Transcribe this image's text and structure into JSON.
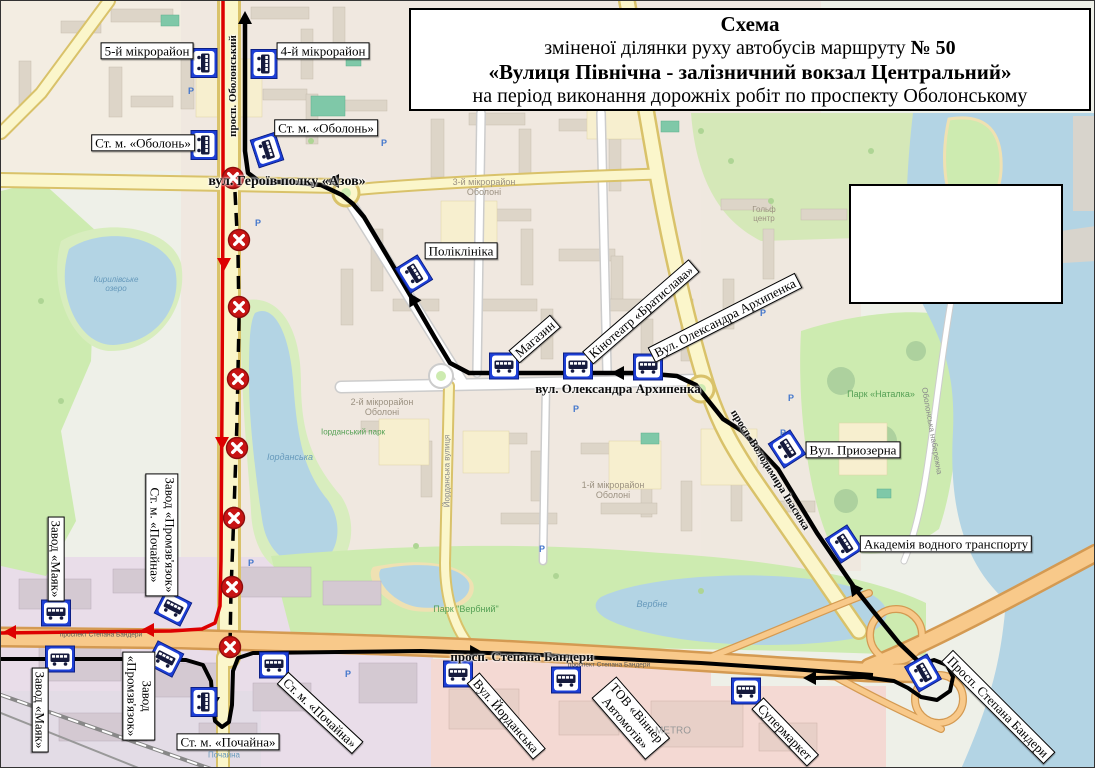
{
  "title_box": {
    "line1": "Схема",
    "line2_prefix": "зміненої ділянки руху автобусів маршруту ",
    "line2_bold": "№ 50",
    "line3": "«Вулиця Північна - залізничний вокзал Центральний»",
    "line4": "на період виконання дорожніх робіт по проспекту Оболонському"
  },
  "colors": {
    "route_new": "#000000",
    "route_closed": "#dd0000",
    "closed_cross_fill": "#c81414",
    "bus_sign_blue": "#1d3fd6",
    "label_bg": "#ffffff",
    "label_border": "#000000"
  },
  "stop_labels": [
    {
      "text": "5-й мікрорайон",
      "x": 146,
      "y": 50,
      "rot": 0
    },
    {
      "text": "4-й мікрорайон",
      "x": 322,
      "y": 50,
      "rot": 0
    },
    {
      "text": "Ст. м. «Оболонь»",
      "x": 142,
      "y": 142,
      "rot": 0
    },
    {
      "text": "Ст. м. «Оболонь»",
      "x": 325,
      "y": 127,
      "rot": 0
    },
    {
      "text": "Поліклініка",
      "x": 460,
      "y": 250,
      "rot": 0
    },
    {
      "text": "Магазин",
      "x": 534,
      "y": 338,
      "rot": -41
    },
    {
      "text": "Кінотеатр «Братислава»",
      "x": 640,
      "y": 311,
      "rot": -41
    },
    {
      "text": "Вул. Олександра Архипенка",
      "x": 724,
      "y": 317,
      "rot": -27
    },
    {
      "text": "Вул. Приозерна",
      "x": 852,
      "y": 449,
      "rot": 0
    },
    {
      "text": "Академія водного транспорту",
      "x": 945,
      "y": 543,
      "rot": 0
    },
    {
      "lines": [
        "Завод «Промзв'язок»",
        "Ст. м. «Почайна»"
      ],
      "x": 161,
      "y": 534,
      "rot": 90
    },
    {
      "text": "Завод «Маяк»",
      "x": 55,
      "y": 558,
      "rot": 90
    },
    {
      "text": "Завод «Маяк»",
      "x": 39,
      "y": 709,
      "rot": 90
    },
    {
      "lines": [
        "Завод",
        "«Промзв'язок»"
      ],
      "x": 138,
      "y": 695,
      "rot": 90
    },
    {
      "text": "Ст. м. «Почайна»",
      "x": 227,
      "y": 741,
      "rot": 0
    },
    {
      "text": "Ст. м. «Почайна»",
      "x": 319,
      "y": 712,
      "rot": 43
    },
    {
      "text": "Вул. Йорданська",
      "x": 505,
      "y": 715,
      "rot": 49
    },
    {
      "lines": [
        "ТОВ «Віннер",
        "Автомотів»"
      ],
      "x": 630,
      "y": 717,
      "rot": 49
    },
    {
      "text": "Супермаркет",
      "x": 784,
      "y": 731,
      "rot": 46
    },
    {
      "text": "Просп. Степана Бандери",
      "x": 997,
      "y": 706,
      "rot": 45
    }
  ],
  "street_labels": [
    {
      "text": "вул. Героїв полку «Азов»",
      "x": 286,
      "y": 181,
      "rot": 0,
      "size": 14
    },
    {
      "text": "вул. Олександра Архипенка",
      "x": 617,
      "y": 388,
      "rot": 0,
      "size": 13
    },
    {
      "text": "просп. Степана Бандери",
      "x": 521,
      "y": 656,
      "rot": 0,
      "size": 13
    },
    {
      "text": "просп. Оболонський",
      "x": 232,
      "y": 85,
      "rot": -90,
      "size": 11
    },
    {
      "text": "просп. Володимира Івасюка",
      "x": 769,
      "y": 469,
      "rot": 58,
      "size": 11
    }
  ],
  "map_labels": [
    {
      "lines": [
        "3-й мікрорайон",
        "Оболоні"
      ],
      "x": 483,
      "y": 186,
      "color": "#9b9181",
      "size": 9
    },
    {
      "lines": [
        "2-й мікрорайон",
        "Оболоні"
      ],
      "x": 381,
      "y": 406,
      "color": "#9b9181",
      "size": 9
    },
    {
      "lines": [
        "1-й мікрорайон",
        "Оболоні"
      ],
      "x": 612,
      "y": 489,
      "color": "#9b9181",
      "size": 9
    },
    {
      "text": "Іорданська",
      "x": 289,
      "y": 456,
      "color": "#6699bb",
      "size": 9,
      "italic": true
    },
    {
      "lines": [
        "Кирилівське",
        "озеро"
      ],
      "x": 115,
      "y": 284,
      "color": "#6699bb",
      "size": 8,
      "italic": true
    },
    {
      "text": "Парк «Наталка»",
      "x": 880,
      "y": 393,
      "color": "#55a055",
      "size": 9
    },
    {
      "text": "Парк \"Вербний\"",
      "x": 465,
      "y": 608,
      "color": "#55a055",
      "size": 9
    },
    {
      "text": "Вербне",
      "x": 651,
      "y": 603,
      "color": "#6699bb",
      "size": 9,
      "italic": true
    },
    {
      "text": "METRO",
      "x": 672,
      "y": 730,
      "color": "#999999",
      "size": 10
    },
    {
      "text": "Почайна",
      "x": 223,
      "y": 755,
      "color": "#6699bb",
      "size": 8
    },
    {
      "lines": [
        "Гольф",
        "центр"
      ],
      "x": 763,
      "y": 214,
      "color": "#9b9181",
      "size": 8
    },
    {
      "text": "Йорданська вулиця",
      "x": 447,
      "y": 470,
      "color": "#8a8a8a",
      "size": 8,
      "rot": -90
    },
    {
      "text": "Іорданський парк",
      "x": 352,
      "y": 432,
      "color": "#55a055",
      "size": 8
    },
    {
      "text": "Оболонська набережна",
      "x": 930,
      "y": 430,
      "color": "#8a8a8a",
      "size": 8,
      "rot": 80
    },
    {
      "text": "проспект Степана Бандери",
      "x": 100,
      "y": 634,
      "color": "#555555",
      "size": 6.5
    },
    {
      "text": "проспект Степана Бандери",
      "x": 608,
      "y": 664,
      "color": "#555555",
      "size": 6.5
    }
  ],
  "bus_stops": [
    [
      203,
      62,
      90
    ],
    [
      263,
      63,
      90
    ],
    [
      203,
      144,
      90
    ],
    [
      266,
      149,
      72
    ],
    [
      413,
      273,
      58
    ],
    [
      503,
      365,
      0
    ],
    [
      577,
      365,
      0
    ],
    [
      647,
      366,
      0
    ],
    [
      786,
      448,
      57
    ],
    [
      843,
      543,
      57
    ],
    [
      55,
      612,
      0
    ],
    [
      59,
      658,
      0
    ],
    [
      172,
      607,
      27
    ],
    [
      164,
      658,
      27
    ],
    [
      273,
      664,
      0
    ],
    [
      203,
      701,
      90
    ],
    [
      457,
      673,
      0
    ],
    [
      565,
      679,
      0
    ],
    [
      745,
      690,
      0
    ],
    [
      922,
      672,
      60
    ]
  ],
  "closed_crossings": [
    [
      232,
      177
    ],
    [
      238,
      239
    ],
    [
      238,
      306
    ],
    [
      237,
      378
    ],
    [
      236,
      447
    ],
    [
      233,
      517
    ],
    [
      231,
      586
    ],
    [
      229,
      646
    ]
  ],
  "routes": [
    {
      "name": "new-route-turn-loop",
      "color": "#000000",
      "width": 4,
      "dash": null,
      "points": [
        [
          920,
          663
        ],
        [
          933,
          659
        ],
        [
          946,
          664
        ],
        [
          952,
          676
        ],
        [
          949,
          690
        ],
        [
          936,
          699
        ],
        [
          920,
          696
        ],
        [
          907,
          687
        ],
        [
          893,
          680
        ],
        [
          862,
          676
        ],
        [
          814,
          677
        ]
      ]
    },
    {
      "name": "new-route-northbound",
      "color": "#000000",
      "width": 4.5,
      "dash": null,
      "points": [
        [
          919,
          662
        ],
        [
          898,
          642
        ],
        [
          872,
          610
        ],
        [
          853,
          586
        ],
        [
          816,
          532
        ],
        [
          777,
          468
        ],
        [
          741,
          430
        ],
        [
          722,
          418
        ],
        [
          706,
          398
        ],
        [
          695,
          384
        ],
        [
          676,
          375
        ],
        [
          640,
          372
        ],
        [
          540,
          372
        ],
        [
          468,
          372
        ],
        [
          449,
          362
        ],
        [
          434,
          337
        ],
        [
          412,
          299
        ],
        [
          388,
          258
        ],
        [
          363,
          216
        ],
        [
          352,
          203
        ],
        [
          341,
          194
        ],
        [
          320,
          184
        ],
        [
          290,
          181
        ],
        [
          259,
          181
        ],
        [
          247,
          172
        ],
        [
          244,
          150
        ],
        [
          244,
          18
        ]
      ]
    },
    {
      "name": "closed-section-dashed",
      "color": "#000000",
      "width": 3.5,
      "dash": "13 8",
      "points": [
        [
          234,
          191
        ],
        [
          237,
          250
        ],
        [
          238,
          320
        ],
        [
          236,
          420
        ],
        [
          233,
          510
        ],
        [
          230,
          590
        ],
        [
          229,
          645
        ]
      ]
    },
    {
      "name": "new-route-southbound",
      "color": "#000000",
      "width": 4,
      "dash": null,
      "points": [
        [
          0,
          658
        ],
        [
          120,
          658
        ],
        [
          185,
          659
        ],
        [
          202,
          664
        ],
        [
          210,
          680
        ],
        [
          212,
          705
        ],
        [
          214,
          720
        ],
        [
          221,
          726
        ],
        [
          228,
          721
        ],
        [
          231,
          704
        ],
        [
          232,
          670
        ],
        [
          237,
          657
        ],
        [
          252,
          652
        ],
        [
          420,
          650
        ],
        [
          520,
          653
        ],
        [
          620,
          658
        ],
        [
          700,
          662
        ],
        [
          790,
          668
        ],
        [
          845,
          672
        ],
        [
          872,
          674
        ]
      ]
    },
    {
      "name": "closed-route-red",
      "color": "#dd0000",
      "width": 3.5,
      "dash": null,
      "points": [
        [
          222,
          0
        ],
        [
          222,
          200
        ],
        [
          221,
          400
        ],
        [
          220,
          560
        ],
        [
          219,
          605
        ],
        [
          214,
          622
        ],
        [
          201,
          628
        ],
        [
          170,
          630
        ],
        [
          80,
          631
        ],
        [
          0,
          632
        ]
      ]
    }
  ],
  "arrows": [
    {
      "x": 244,
      "y": 22,
      "angle": -90,
      "color": "#000000"
    },
    {
      "x": 337,
      "y": 180,
      "angle": 180,
      "color": "#000000"
    },
    {
      "x": 414,
      "y": 302,
      "angle": -121,
      "color": "#000000"
    },
    {
      "x": 622,
      "y": 372,
      "angle": 180,
      "color": "#000000"
    },
    {
      "x": 856,
      "y": 591,
      "angle": -128,
      "color": "#000000"
    },
    {
      "x": 470,
      "y": 651,
      "angle": 1,
      "color": "#000000"
    },
    {
      "x": 814,
      "y": 677,
      "angle": 180,
      "color": "#000000"
    },
    {
      "x": 212,
      "y": 697,
      "angle": 91,
      "color": "#000000"
    },
    {
      "x": 223,
      "y": 258,
      "angle": 90,
      "color": "#dd0000"
    },
    {
      "x": 221,
      "y": 437,
      "angle": 90,
      "color": "#dd0000"
    },
    {
      "x": 152,
      "y": 629,
      "angle": 180,
      "color": "#dd0000"
    },
    {
      "x": 14,
      "y": 631,
      "angle": 180,
      "color": "#dd0000"
    }
  ],
  "parking_markers": [
    [
      190,
      90
    ],
    [
      257,
      222
    ],
    [
      383,
      142
    ],
    [
      575,
      408
    ],
    [
      762,
      312
    ],
    [
      790,
      397
    ],
    [
      250,
      562
    ],
    [
      347,
      673
    ],
    [
      782,
      432
    ],
    [
      541,
      548
    ]
  ],
  "legend_box": {
    "x": 848,
    "y": 183,
    "w": 214,
    "h": 120
  }
}
